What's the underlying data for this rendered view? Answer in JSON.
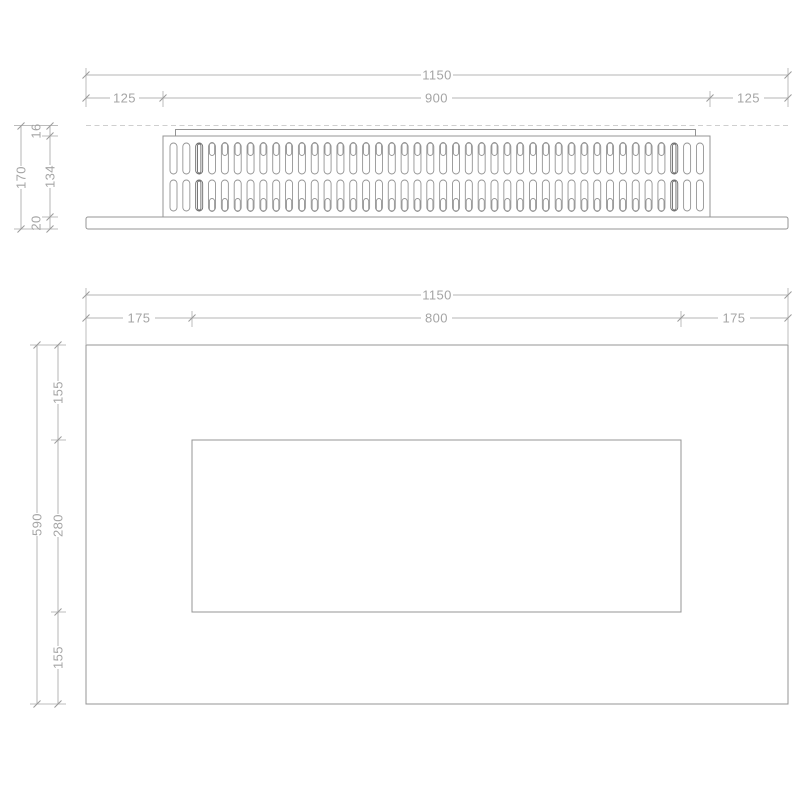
{
  "page": {
    "background": "#ffffff",
    "description": "Technical dimension drawing, two orthographic views of a wall fireplace / grille panel"
  },
  "colors": {
    "dimension_line": "#b5b5b5",
    "extension_line": "#bdbdbd",
    "tick_color": "#9a9a9a",
    "dashed_line": "#cfcfcf",
    "object_line": "#949494",
    "object_dark_line": "#6a6a6a",
    "dimension_text": "#a5a5a5"
  },
  "top_view": {
    "dims": {
      "total_width": "1150",
      "left": "125",
      "center": "900",
      "right": "125",
      "total_height": "170",
      "lip": "16",
      "body": "134",
      "base": "20"
    },
    "grille": {
      "columns": 42,
      "rows": 2,
      "x_start": 170,
      "pitch": 12.84,
      "slot_width": 7,
      "row1_top": 143,
      "row2_top": 180,
      "slot_height": 31,
      "notch_height": 13,
      "plain_columns": [
        0,
        1,
        40,
        41
      ],
      "dark_columns": [
        2,
        39
      ]
    }
  },
  "front_view": {
    "dims": {
      "total_width": "1150",
      "left": "175",
      "opening_width": "800",
      "right": "175",
      "total_height": "590",
      "top": "155",
      "opening_height": "280",
      "bottom": "155"
    }
  }
}
